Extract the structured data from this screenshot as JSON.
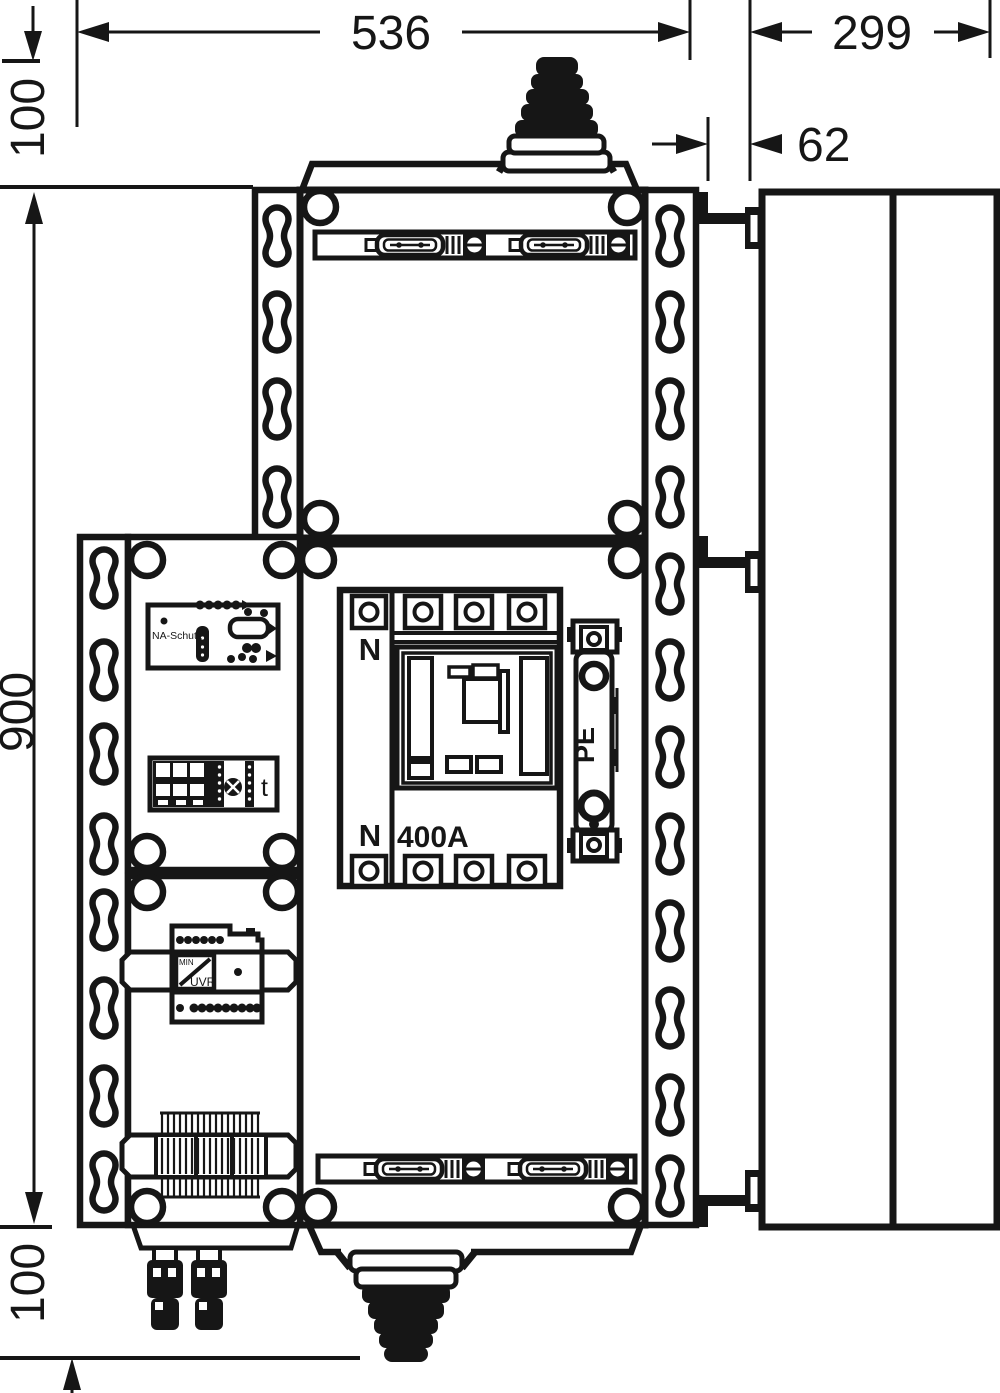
{
  "dimensions": {
    "overall_width": "536",
    "side_depth": "299",
    "top_gland_height": "100",
    "bracket_offset": "62",
    "overall_height": "900",
    "bottom_gland_height": "100"
  },
  "labels": {
    "neutral_top": "N",
    "neutral_bottom": "N",
    "breaker_rating": "400A",
    "pe_terminal": "PE",
    "na_schutz_relay": "NA-Schutz",
    "timer": "t",
    "uvr_min": "MIN",
    "uvr": "UVR"
  }
}
